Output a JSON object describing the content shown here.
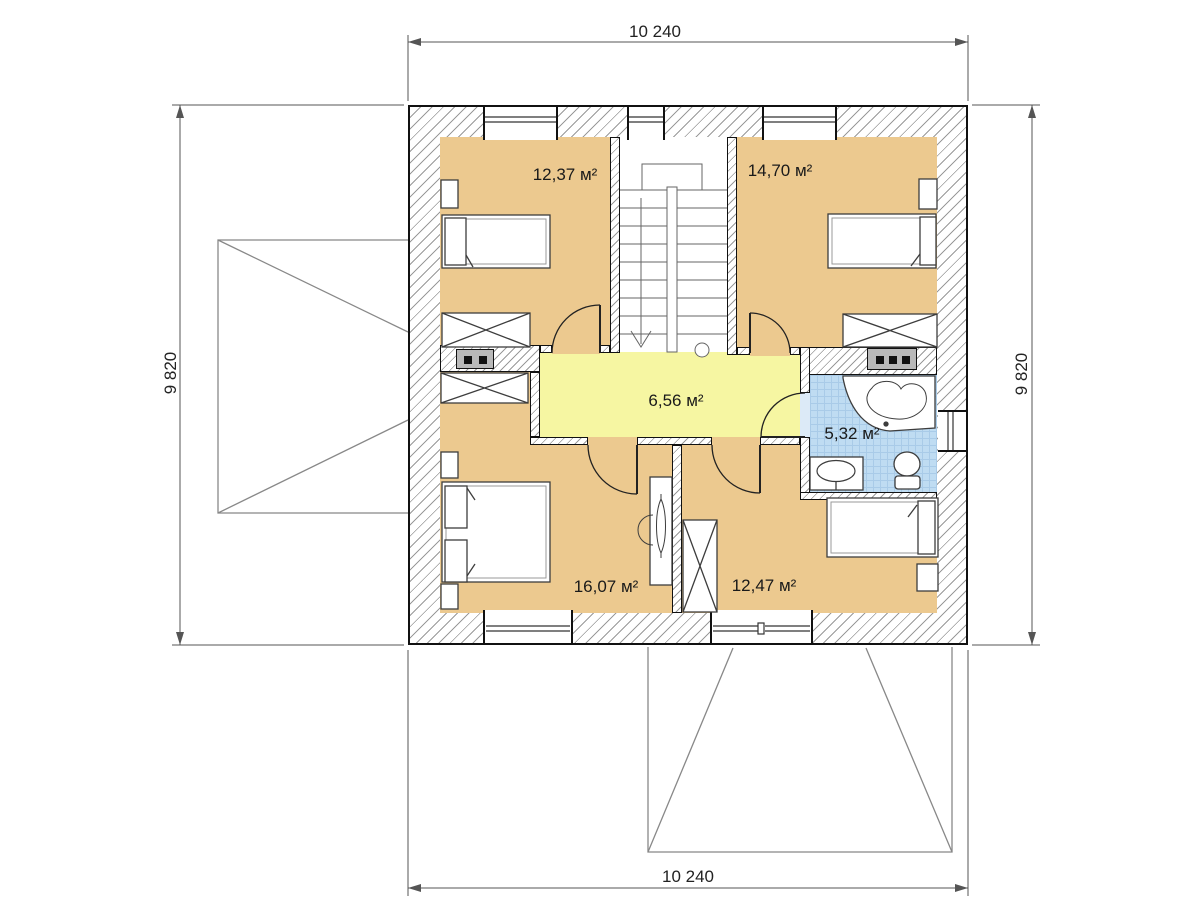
{
  "plan": {
    "dimensions": {
      "top": "10 240",
      "bottom": "10 240",
      "left": "9 820",
      "right": "9 820"
    },
    "rooms": [
      {
        "name": "bedroom-top-left",
        "area_label": "12,37 м²"
      },
      {
        "name": "bedroom-top-right",
        "area_label": "14,70 м²"
      },
      {
        "name": "hallway",
        "area_label": "6,56 м²"
      },
      {
        "name": "bathroom",
        "area_label": "5,32 м²"
      },
      {
        "name": "bedroom-bottom-left",
        "area_label": "16,07 м²"
      },
      {
        "name": "bedroom-bottom-right",
        "area_label": "12,47 м²"
      }
    ],
    "colors": {
      "bedroom_fill": "#ecc98f",
      "hallway_fill": "#f6f6a2",
      "bathroom_fill": "#bfdcf2",
      "wall_hatch": "#9a9a9a",
      "outline": "#111111"
    }
  }
}
